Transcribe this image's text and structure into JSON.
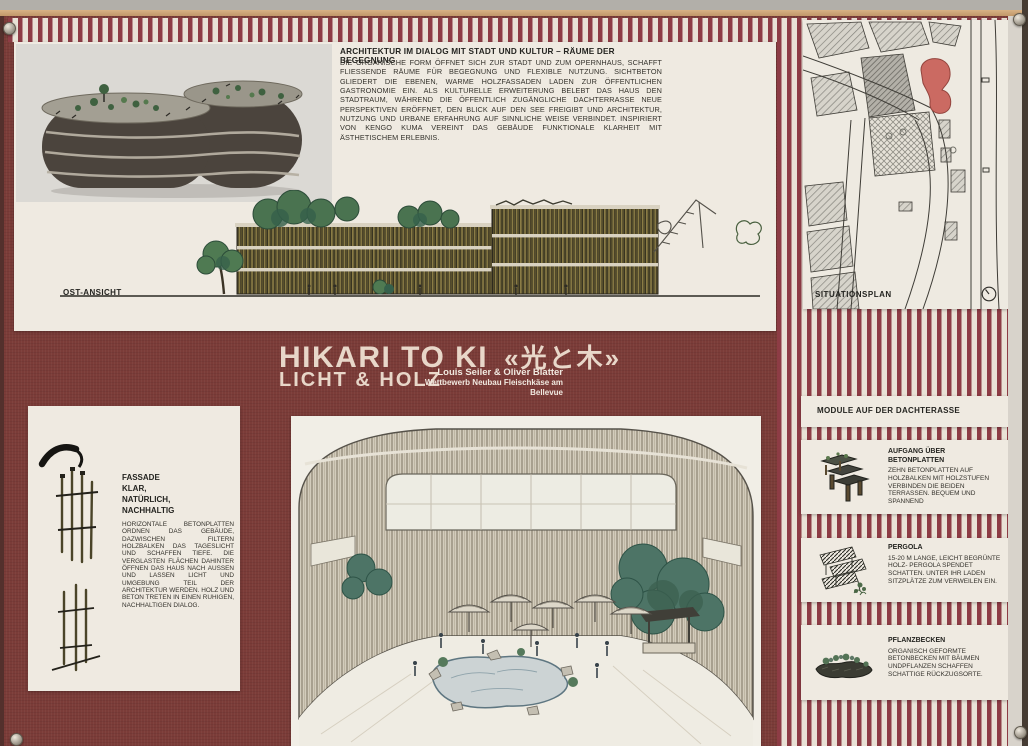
{
  "intro": {
    "heading": "ARCHITEKTUR IM DIALOG MIT STADT UND KULTUR – RÄUME DER BEGEGNUNG",
    "body": "DIE ORGANISCHE FORM ÖFFNET SICH ZUR STADT UND ZUM OPERNHAUS, SCHAFFT FLIESSENDE RÄUME FÜR BEGEGNUNG UND FLEXIBLE NUTZUNG. SICHTBETON GLIEDERT DIE EBENEN, WARME HOLZFASSADEN LADEN ZUR ÖFFENTLICHEN GASTRONOMIE EIN. ALS KULTURELLE ERWEITERUNG BELEBT DAS HAUS DEN STADTRAUM, WÄHREND DIE ÖFFENTLICH ZUGÄNGLICHE DACHTERRASSE NEUE PERSPEKTIVEN ERÖFFNET, DEN BLICK AUF DEN SEE FREIGIBT UND ARCHITEKTUR, NUTZUNG UND URBANE ERFAHRUNG AUF SINNLICHE WEISE VERBINDET. INSPIRIERT VON KENGO KUMA VEREINT DAS GEBÄUDE FUNKTIONALE KLARHEIT MIT ÄSTHETISCHEM ERLEBNIS."
  },
  "elevation": {
    "label": "OST-ANSICHT"
  },
  "title_band": {
    "title": "HIKARI TO KI",
    "title_jp": "«光と木»",
    "subtitle": "LICHT & HOLZ",
    "authors": "Louis Seiler & Oliver Blatter",
    "competition": "Wettbewerb Neubau Fleischkäse am Bellevue"
  },
  "facade_panel": {
    "heading_lines": [
      "FASSADE",
      "KLAR,",
      "NATÜRLICH,",
      "NACHHALTIG"
    ],
    "body": "HORIZONTALE BETONPLATTEN ORDNEN DAS GEBÄUDE, DAZWISCHEN FILTERN HOLZBALKEN DAS TAGESLICHT UND SCHAFFEN TIEFE. DIE VERGLASTEN FLÄCHEN DAHINTER ÖFFNEN DAS HAUS NACH AUSSEN UND LASSEN LICHT UND UMGEBUNG TEIL DER ARCHITEKTUR WERDEN. HOLZ UND BETON TRETEN IN EINEN RUHIGEN, NACHHALTIGEN DIALOG."
  },
  "situationsplan": {
    "label": "SITUATIONSPLAN",
    "north_icon": "north-arrow-icon"
  },
  "modules": {
    "heading": "MODULE AUF DER DACHTERASSE",
    "items": [
      {
        "icon": "concrete-steps-icon",
        "title": "AUFGANG ÜBER BETONPLATTEN",
        "body": "ZEHN BETONPLATTEN AUF HOLZBALKEN MIT HOLZSTUFEN VERBINDEN DIE BEIDEN TERRASSEN. BEQUEM UND SPANNEND"
      },
      {
        "icon": "pergola-icon",
        "title": "PERGOLA",
        "body": "15-20 M LANGE, LEICHT BEGRÜNTE HOLZ- PERGOLA SPENDET SCHATTEN. UNTER IHR LADEN SITZPLÄTZE ZUM VERWEILEN EIN."
      },
      {
        "icon": "planter-icon",
        "title": "PFLANZBECKEN",
        "body": "ORGANISCH GEFORMTE BETONBECKEN MIT BÄUMEN UNDPFLANZEN SCHAFFEN SCHATTIGE RÜCKZUGSORTE."
      }
    ]
  },
  "colors": {
    "maroon": "#7b3c38",
    "stripe_red": "#8d3c45",
    "stripe_cream": "#e9e2d6",
    "panel": "#efeae1",
    "site_red": "#cb6a62"
  }
}
